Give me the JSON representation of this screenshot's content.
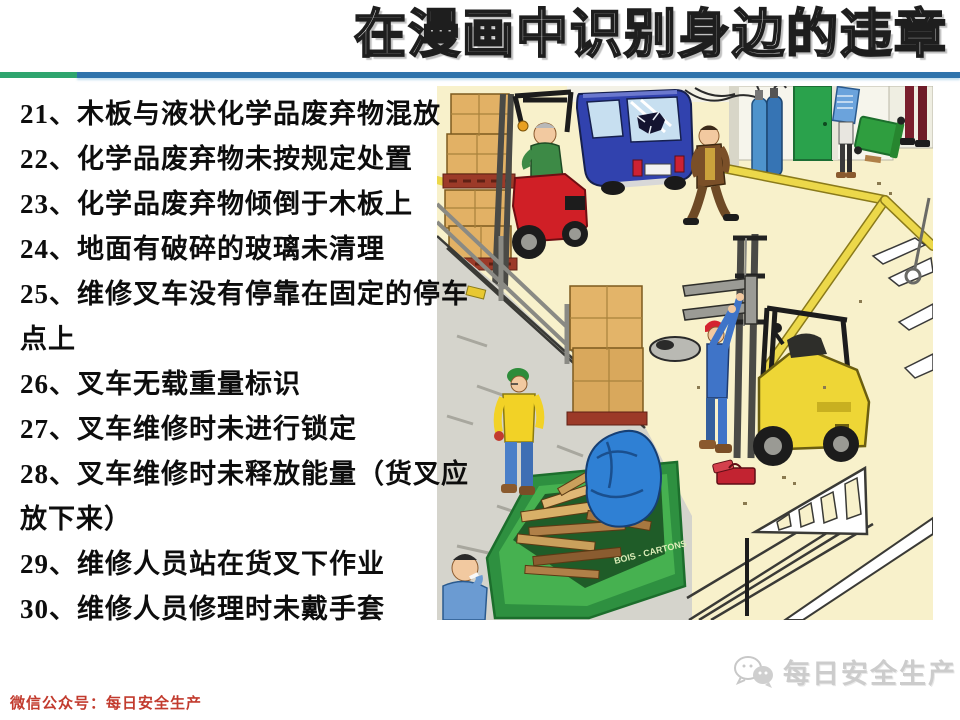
{
  "title": {
    "text": "在漫画中识别身边的违章"
  },
  "divider": {
    "green": "#2fa56e",
    "blue": "#2e73ac"
  },
  "violations": {
    "items": [
      {
        "id": "21",
        "text": "木板与液状化学品废弃物混放",
        "lines": [
          "21、木板与液状化学品废弃物混放"
        ]
      },
      {
        "id": "22",
        "text": "化学品废弃物未按规定处置",
        "lines": [
          "22、化学品废弃物未按规定处置"
        ]
      },
      {
        "id": "23",
        "text": "化学品废弃物倾倒于木板上",
        "lines": [
          "23、化学品废弃物倾倒于木板上"
        ]
      },
      {
        "id": "24",
        "text": "地面有破碎的玻璃未清理",
        "lines": [
          "24、地面有破碎的玻璃未清理"
        ]
      },
      {
        "id": "25",
        "text": "维修叉车没有停靠在固定的停车点上",
        "lines": [
          "25、维修叉车没有停靠在固定的停车",
          "点上"
        ]
      },
      {
        "id": "26",
        "text": "叉车无载重量标识",
        "lines": [
          "26、叉车无载重量标识"
        ]
      },
      {
        "id": "27",
        "text": "叉车维修时未进行锁定",
        "lines": [
          "27、叉车维修时未进行锁定"
        ]
      },
      {
        "id": "28",
        "text": "叉车维修时未释放能量（货叉应放下来）",
        "lines": [
          "28、叉车维修时未释放能量（货叉应",
          "放下来）"
        ]
      },
      {
        "id": "29",
        "text": "维修人员站在货叉下作业",
        "lines": [
          "29、维修人员站在货叉下作业"
        ]
      },
      {
        "id": "30",
        "text": "维修人员修理时未戴手套",
        "lines": [
          "30、维修人员修理时未戴手套"
        ]
      }
    ]
  },
  "footer": {
    "wechat_label": "微信公众号：每日安全生产",
    "color": "#c23b2e"
  },
  "watermark": {
    "icon": "wechat-icon",
    "text": "每日安全生产",
    "color": "#cccccc"
  },
  "illustration": {
    "description": "warehouse safety cartoon",
    "dumpster_label": "BOIS - CARTONS",
    "colors": {
      "floor": "#f8f1cb",
      "concrete": "#d5d4cc",
      "red_forklift": "#d01f26",
      "yellow_forklift": "#eed636",
      "blue_van": "#3142ae",
      "green_door": "#2aa24c",
      "green_dumpster": "#3fae4a",
      "yellow_line": "#ecd84a",
      "blue_tarp": "#2f80d4"
    },
    "scene_elements": [
      "red-forklift-with-driver",
      "stacked-cardboard-boxes",
      "blue-van-broken-window",
      "walking-worker-brown-jacket",
      "green-door",
      "gas-cylinders",
      "newspaper-reader",
      "tipped-green-bin",
      "person-legs-right-edge",
      "yellow-walkway-lines",
      "crosswalk-stripes",
      "yellow-forklift-raised-forks",
      "mechanic-under-forks",
      "red-toolbox",
      "hubcap-dish",
      "green-dumpster-wood-scraps",
      "blue-tarp",
      "worker-yellow-jacket",
      "worker-blue-bottom-left",
      "dock-railing",
      "ramp-marking"
    ]
  }
}
